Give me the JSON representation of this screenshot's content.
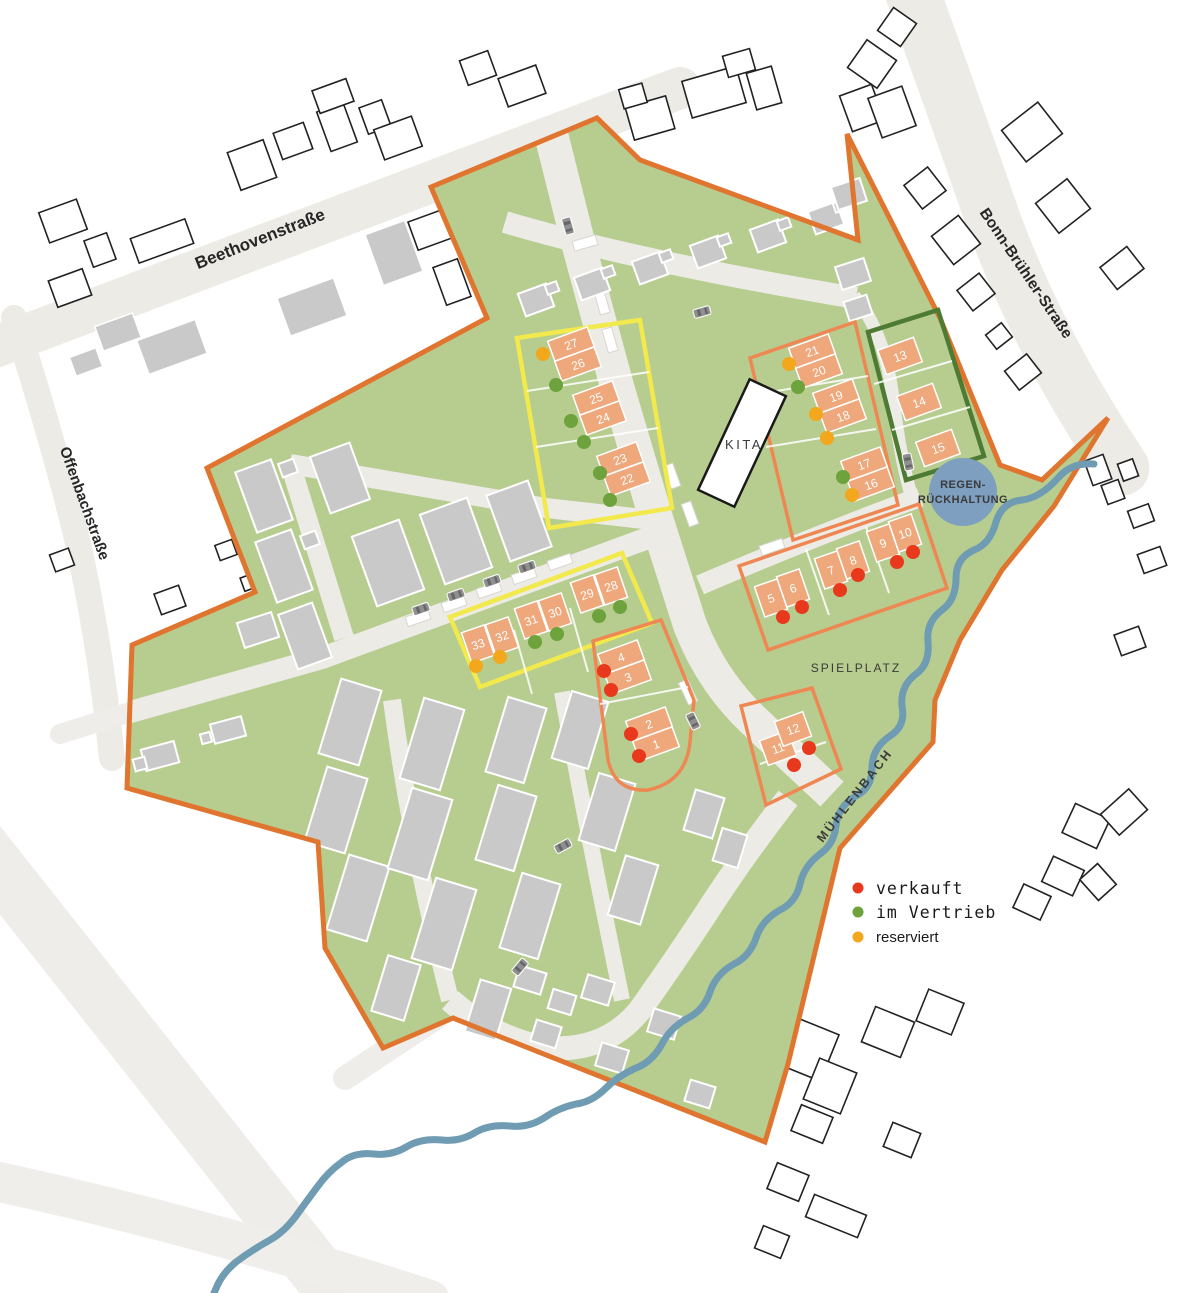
{
  "legend": {
    "items": [
      {
        "label": "verkauft",
        "status": "verkauft",
        "color": "#e8391d"
      },
      {
        "label": "im Vertrieb",
        "status": "im_vertrieb",
        "color": "#6da23c"
      },
      {
        "label": "reserviert",
        "status": "reserviert",
        "color": "#f3a71c"
      }
    ]
  },
  "streets": [
    {
      "name": "Beethovenstraße"
    },
    {
      "name": "Offenbachstraße"
    },
    {
      "name": "Bonn-Brühler-Straße"
    }
  ],
  "water": {
    "name": "MÜHLENBACH"
  },
  "areas": {
    "kita": "KITA",
    "spielplatz": "SPIELPLATZ",
    "retention": [
      "REGEN-",
      "RÜCKHALTUNG"
    ]
  },
  "plots": [
    {
      "no": "1",
      "status": "verkauft"
    },
    {
      "no": "2",
      "status": "verkauft"
    },
    {
      "no": "3",
      "status": "verkauft"
    },
    {
      "no": "4",
      "status": "verkauft"
    },
    {
      "no": "5",
      "status": "verkauft"
    },
    {
      "no": "6",
      "status": "verkauft"
    },
    {
      "no": "7",
      "status": "verkauft"
    },
    {
      "no": "8",
      "status": "verkauft"
    },
    {
      "no": "9",
      "status": "verkauft"
    },
    {
      "no": "10",
      "status": "verkauft"
    },
    {
      "no": "11",
      "status": "verkauft"
    },
    {
      "no": "12",
      "status": "verkauft"
    },
    {
      "no": "13",
      "status": null
    },
    {
      "no": "14",
      "status": null
    },
    {
      "no": "15",
      "status": null
    },
    {
      "no": "16",
      "status": "reserviert"
    },
    {
      "no": "17",
      "status": "im_vertrieb"
    },
    {
      "no": "18",
      "status": "reserviert"
    },
    {
      "no": "19",
      "status": "reserviert"
    },
    {
      "no": "20",
      "status": "im_vertrieb"
    },
    {
      "no": "21",
      "status": "reserviert"
    },
    {
      "no": "22",
      "status": "im_vertrieb"
    },
    {
      "no": "23",
      "status": "im_vertrieb"
    },
    {
      "no": "24",
      "status": "im_vertrieb"
    },
    {
      "no": "25",
      "status": "im_vertrieb"
    },
    {
      "no": "26",
      "status": "im_vertrieb"
    },
    {
      "no": "27",
      "status": "reserviert"
    },
    {
      "no": "28",
      "status": "im_vertrieb"
    },
    {
      "no": "29",
      "status": "im_vertrieb"
    },
    {
      "no": "30",
      "status": "im_vertrieb"
    },
    {
      "no": "31",
      "status": "im_vertrieb"
    },
    {
      "no": "32",
      "status": "reserviert"
    },
    {
      "no": "33",
      "status": "reserviert"
    }
  ],
  "colors": {
    "site_green": "#b7cd90",
    "site_border": "#e0752f",
    "house": "#eea87c",
    "garage": "#f6e3a9",
    "group_yellow": "#f2e94c",
    "group_orange": "#ef8753",
    "group_green": "#4e7b33",
    "road": "#edebe6",
    "building_gray": "#c9c9c9",
    "building_white": "#ffffff",
    "water": "#6f9cb2",
    "retention_fill": "#7e9fc0",
    "car_gray": "#8f8f8f"
  }
}
